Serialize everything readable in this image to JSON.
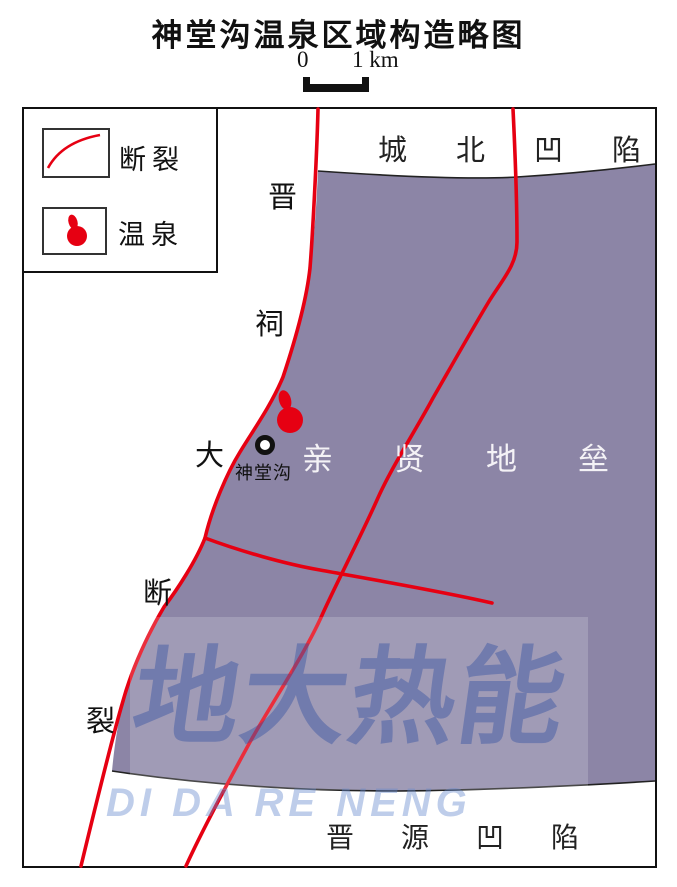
{
  "title": "神堂沟温泉区域构造略图",
  "scale_bar": {
    "start_label": "0",
    "end_label": "1 km"
  },
  "legend": {
    "items": [
      {
        "label": "断裂",
        "symbol": "fault-line"
      },
      {
        "label": "温泉",
        "symbol": "hot-spring-blob"
      }
    ]
  },
  "map": {
    "region_labels": {
      "north_sag": "城北凹陷",
      "horst": "亲贤地垒",
      "south_sag": "晋源凹陷"
    },
    "fault_name": "晋祠大断裂",
    "fault_name_chars": [
      "晋",
      "祠",
      "大",
      "断",
      "裂"
    ],
    "spring_point_label": "神堂沟"
  },
  "watermark": {
    "cn": "地大热能",
    "en": "DI DA RE NENG"
  },
  "colors": {
    "horst_fill": "#8c85a6",
    "fault_red": "#e60012",
    "boundary_line": "#222222",
    "watermark_blue": "#2f4fa3",
    "frame_black": "#111111"
  }
}
